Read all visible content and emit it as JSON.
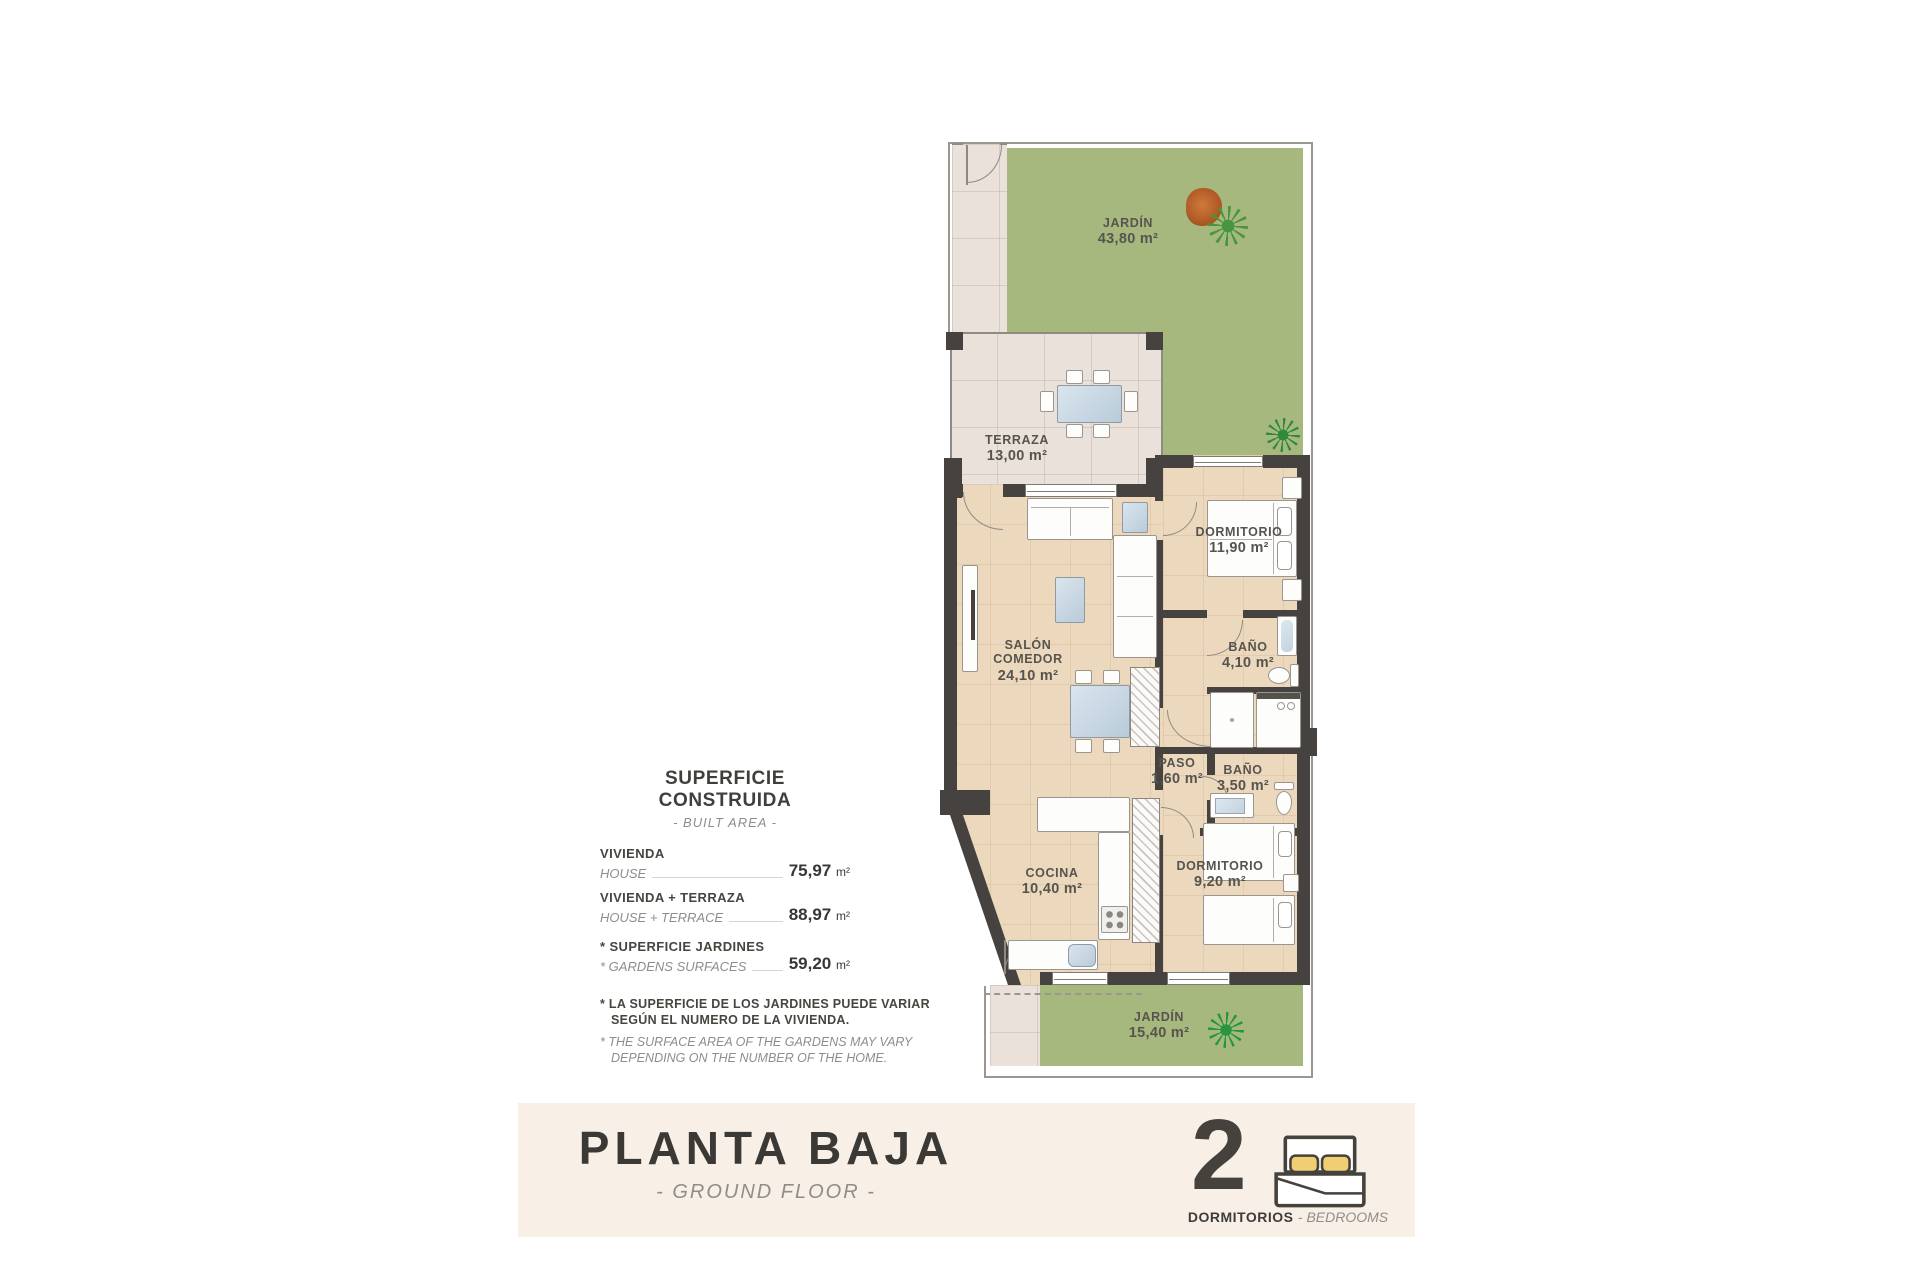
{
  "plan": {
    "rooms": {
      "jardin_top": {
        "name": "JARDÍN",
        "area": "43,80 m²"
      },
      "terraza": {
        "name": "TERRAZA",
        "area": "13,00 m²"
      },
      "dormitorio_1": {
        "name": "DORMITORIO",
        "area": "11,90 m²"
      },
      "salon": {
        "name_line1": "SALÓN",
        "name_line2": "COMEDOR",
        "area": "24,10 m²"
      },
      "bano_1": {
        "name": "BAÑO",
        "area": "4,10 m²"
      },
      "paso": {
        "name": "PASO",
        "area": "1,60 m²"
      },
      "bano_2": {
        "name": "BAÑO",
        "area": "3,50 m²"
      },
      "cocina": {
        "name": "COCINA",
        "area": "10,40 m²"
      },
      "dormitorio_2": {
        "name": "DORMITORIO",
        "area": "9,20 m²"
      },
      "jardin_bottom": {
        "name": "JARDÍN",
        "area": "15,40 m²"
      }
    }
  },
  "surface_panel": {
    "title": "SUPERFICIE CONSTRUIDA",
    "subtitle": "- BUILT AREA -",
    "rows": [
      {
        "label_es": "VIVIENDA",
        "label_en": "HOUSE",
        "value": "75,97",
        "unit": "m²"
      },
      {
        "label_es": "VIVIENDA + TERRAZA",
        "label_en": "HOUSE + TERRACE",
        "value": "88,97",
        "unit": "m²"
      },
      {
        "label_es": "* SUPERFICIE JARDINES",
        "label_en": "* GARDENS SURFACES",
        "value": "59,20",
        "unit": "m²"
      }
    ]
  },
  "notes": {
    "es_line1": "* LA SUPERFICIE DE LOS JARDINES PUEDE VARIAR",
    "es_line2": "SEGÚN EL NUMERO DE LA VIVIENDA.",
    "en_line1": "* THE SURFACE AREA OF THE GARDENS MAY VARY",
    "en_line2": "DEPENDING ON THE NUMBER OF THE HOME."
  },
  "footer": {
    "title": "PLANTA BAJA",
    "subtitle": "- GROUND FLOOR -",
    "bedrooms_count": "2",
    "bedrooms_label": "DORMITORIOS",
    "bedrooms_label_en": "- BEDROOMS"
  },
  "colors": {
    "wall": "#454240",
    "garden": "#a6b87e",
    "floor": "#ecd8bc",
    "tile": "#eae2da",
    "cream": "#f8f0e7",
    "pillow": "#f0cf72",
    "label": "#56544e",
    "text_dark": "#3e3c38",
    "text_muted": "#8f8d89"
  }
}
